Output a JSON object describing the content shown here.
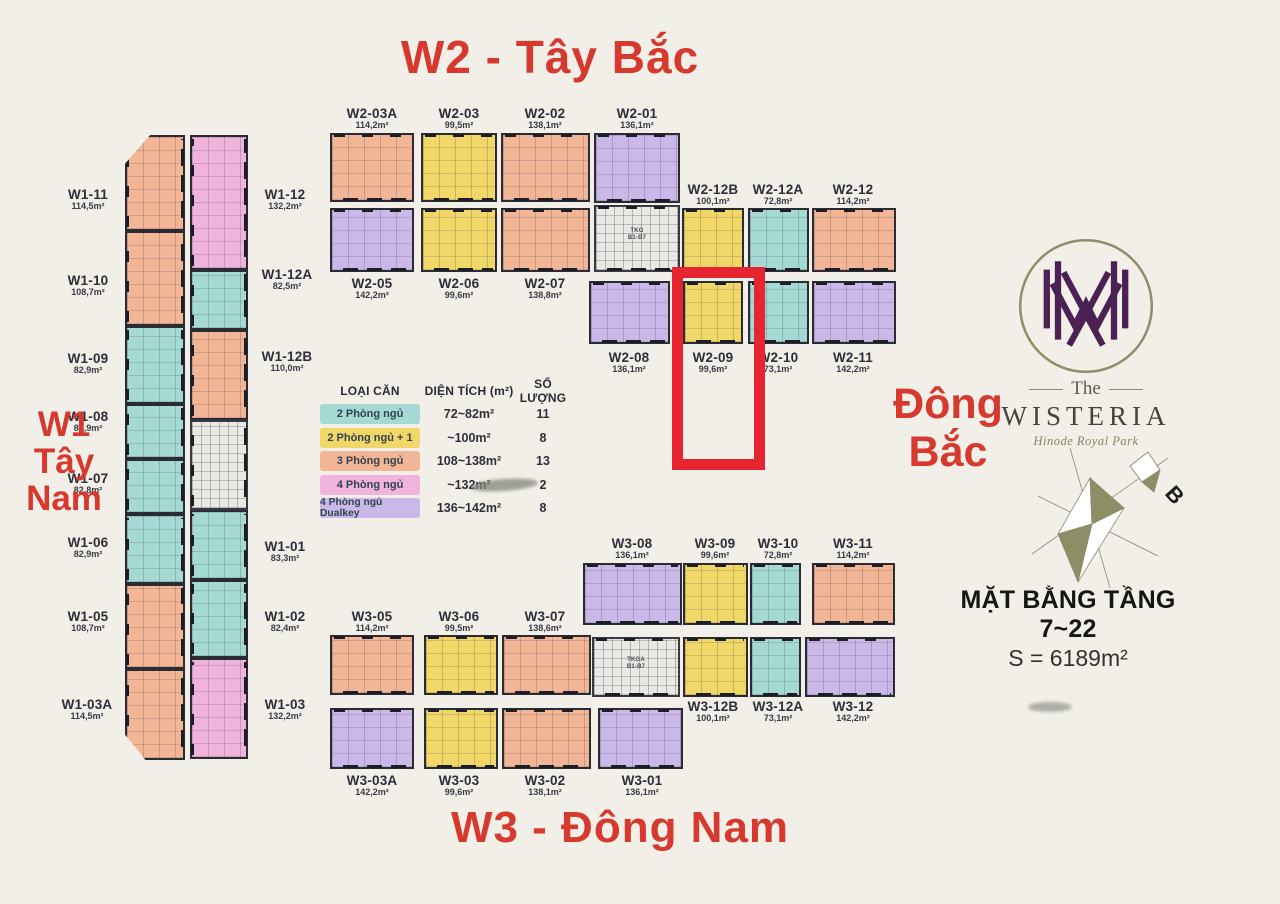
{
  "colors": {
    "salmon": "#f2b697",
    "teal": "#a5d9d4",
    "yellow": "#f1d768",
    "pink": "#efb3dc",
    "purple": "#cab8e8",
    "core": "#e9e8e2",
    "red_accent": "#d6392e",
    "highlight_red": "#e62530",
    "background": "#f2efe9"
  },
  "titles": {
    "top": "W2 - Tây Bắc",
    "bottom": "W3 - Đông Nam",
    "left": [
      "W1",
      "Tây",
      "Nam"
    ],
    "right": [
      "Đông",
      "Bắc"
    ]
  },
  "legend": {
    "headers": [
      "LOẠI CĂN",
      "DIỆN TÍCH (m²)",
      "SỐ LƯỢNG"
    ],
    "rows": [
      {
        "label": "2 Phòng ngủ",
        "fill": "teal",
        "range": "72~82m²",
        "count": "11"
      },
      {
        "label": "2 Phòng ngủ + 1",
        "fill": "yellow",
        "range": "~100m²",
        "count": "8"
      },
      {
        "label": "3 Phòng ngủ",
        "fill": "salmon",
        "range": "108~138m²",
        "count": "13"
      },
      {
        "label": "4 Phòng ngủ",
        "fill": "pink",
        "range": "~132m²",
        "count": "2"
      },
      {
        "label": "4 Phòng ngủ Dualkey",
        "fill": "purple",
        "range": "136~142m²",
        "count": "8"
      }
    ]
  },
  "logo": {
    "the": "The",
    "name": "WISTERIA",
    "subtitle": "Hinode Royal Park"
  },
  "compass": {
    "north": "B"
  },
  "plate": {
    "title": "MẶT BẰNG TẦNG 7~22",
    "area": "S = 6189m²"
  },
  "cores": {
    "w2": [
      "TKG",
      "B1-B7"
    ],
    "w3": [
      "TKGA",
      "B1-B7"
    ]
  },
  "highlight": {
    "unit_id": "W2-09"
  },
  "units": {
    "w1_left": [
      {
        "id": "W1-11",
        "area": "114,5m²",
        "fill": "salmon"
      },
      {
        "id": "W1-10",
        "area": "108,7m²",
        "fill": "salmon"
      },
      {
        "id": "W1-09",
        "area": "82,9m²",
        "fill": "teal"
      },
      {
        "id": "W1-08",
        "area": "82,9m²",
        "fill": "teal"
      },
      {
        "id": "W1-07",
        "area": "82,8m²",
        "fill": "teal"
      },
      {
        "id": "W1-06",
        "area": "82,9m²",
        "fill": "teal"
      },
      {
        "id": "W1-05",
        "area": "108,7m²",
        "fill": "salmon"
      },
      {
        "id": "W1-03A",
        "area": "114,5m²",
        "fill": "salmon"
      }
    ],
    "w1_right": [
      {
        "id": "W1-12",
        "area": "132,2m²",
        "fill": "pink"
      },
      {
        "id": "W1-12A",
        "area": "82,5m²",
        "fill": "teal"
      },
      {
        "id": "W1-12B",
        "area": "110,0m²",
        "fill": "salmon"
      },
      {
        "id": "W1-01",
        "area": "83,3m²",
        "fill": "teal"
      },
      {
        "id": "W1-02",
        "area": "82,4m²",
        "fill": "teal"
      },
      {
        "id": "W1-03",
        "area": "132,2m²",
        "fill": "pink"
      }
    ],
    "w2_row1": [
      {
        "id": "W2-03A",
        "area": "114,2m²",
        "fill": "salmon"
      },
      {
        "id": "W2-03",
        "area": "99,5m²",
        "fill": "yellow"
      },
      {
        "id": "W2-02",
        "area": "138,1m²",
        "fill": "salmon"
      },
      {
        "id": "W2-01",
        "area": "136,1m²",
        "fill": "purple"
      }
    ],
    "w2_row2": [
      {
        "id": "W2-05",
        "area": "142,2m²",
        "fill": "purple"
      },
      {
        "id": "W2-06",
        "area": "99,6m²",
        "fill": "yellow"
      },
      {
        "id": "W2-07",
        "area": "138,8m²",
        "fill": "salmon"
      }
    ],
    "w2_wing_top": [
      {
        "id": "W2-12B",
        "area": "100,1m²",
        "fill": "yellow"
      },
      {
        "id": "W2-12A",
        "area": "72,8m²",
        "fill": "teal"
      },
      {
        "id": "W2-12",
        "area": "114,2m²",
        "fill": "salmon"
      }
    ],
    "w2_wing_bottom": [
      {
        "id": "W2-08",
        "area": "136,1m²",
        "fill": "purple"
      },
      {
        "id": "W2-09",
        "area": "99,6m²",
        "fill": "yellow"
      },
      {
        "id": "W2-10",
        "area": "73,1m²",
        "fill": "teal"
      },
      {
        "id": "W2-11",
        "area": "142,2m²",
        "fill": "purple"
      }
    ],
    "w3_wing_top": [
      {
        "id": "W3-08",
        "area": "136,1m²",
        "fill": "purple"
      },
      {
        "id": "W3-09",
        "area": "99,6m²",
        "fill": "yellow"
      },
      {
        "id": "W3-10",
        "area": "72,8m²",
        "fill": "teal"
      },
      {
        "id": "W3-11",
        "area": "114,2m²",
        "fill": "salmon"
      }
    ],
    "w3_wing_mid": [
      {
        "id": "W3-12B",
        "area": "100,1m²",
        "fill": "yellow"
      },
      {
        "id": "W3-12A",
        "area": "73,1m²",
        "fill": "teal"
      },
      {
        "id": "W3-12",
        "area": "142,2m²",
        "fill": "purple"
      }
    ],
    "w3_row1": [
      {
        "id": "W3-05",
        "area": "114,2m²",
        "fill": "salmon"
      },
      {
        "id": "W3-06",
        "area": "99,5m²",
        "fill": "yellow"
      },
      {
        "id": "W3-07",
        "area": "138,6m²",
        "fill": "salmon"
      }
    ],
    "w3_row2": [
      {
        "id": "W3-03A",
        "area": "142,2m²",
        "fill": "purple"
      },
      {
        "id": "W3-03",
        "area": "99,6m²",
        "fill": "yellow"
      },
      {
        "id": "W3-02",
        "area": "138,1m²",
        "fill": "salmon"
      },
      {
        "id": "W3-01",
        "area": "136,1m²",
        "fill": "purple"
      }
    ]
  }
}
